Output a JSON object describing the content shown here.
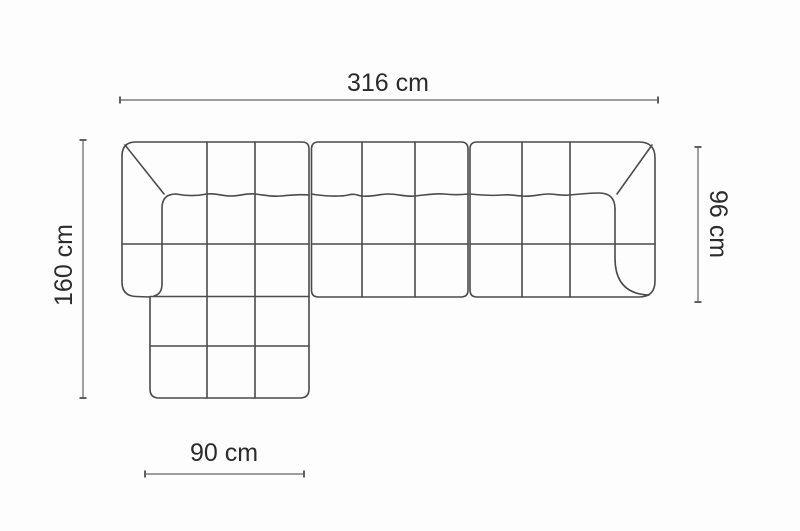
{
  "diagram": {
    "figure": "corner-sofa-top-view",
    "dimensions": {
      "total_width": {
        "label": "316 cm",
        "value": 316,
        "unit": "cm"
      },
      "total_depth": {
        "label": "160 cm",
        "value": 160,
        "unit": "cm"
      },
      "body_depth": {
        "label": "96 cm",
        "value": 96,
        "unit": "cm"
      },
      "chaise_width": {
        "label": "90 cm",
        "value": 90,
        "unit": "cm"
      }
    },
    "colors": {
      "background": "#fdfdfd",
      "sofa_outline": "#4b4b4b",
      "dimension_line": "#8f8f8f",
      "tick": "#5f5f5f",
      "text": "#2b2b2b"
    }
  }
}
